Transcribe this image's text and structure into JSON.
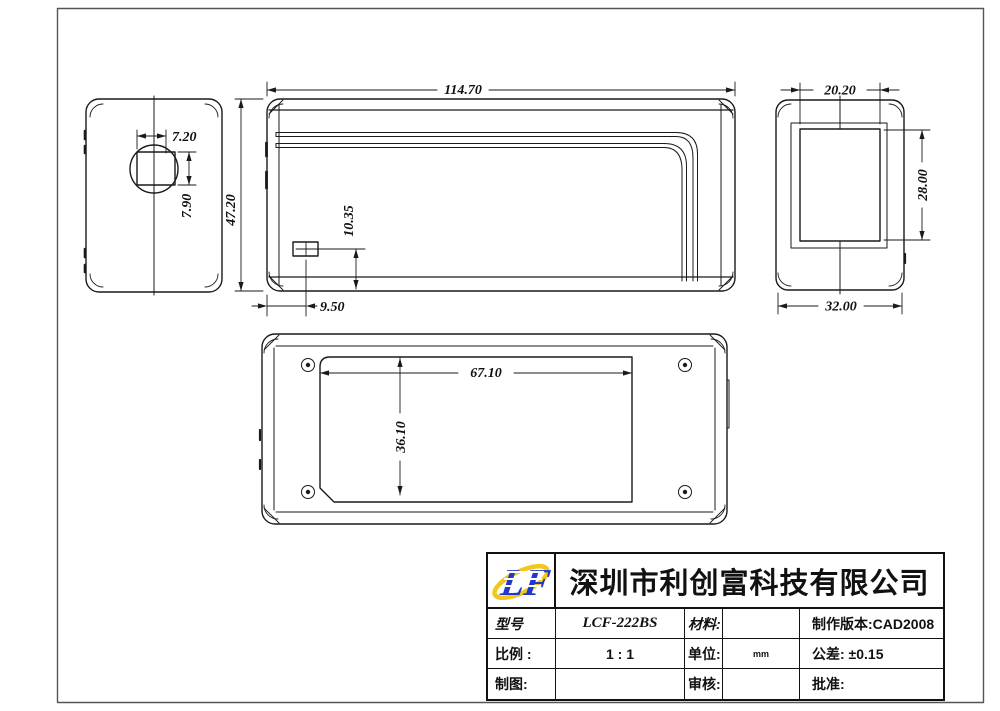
{
  "drawing": {
    "type": "CAD orthographic views of power adapter enclosure",
    "views": [
      "left-end-view",
      "front-view",
      "right-end-view",
      "bottom-view"
    ]
  },
  "dims": {
    "front_width": "114.70",
    "front_height": "47.20",
    "pin_hole_width": "7.20",
    "pin_hole_height": "7.90",
    "led_offset_x": "9.50",
    "led_offset_y": "10.35",
    "recess_width": "20.20",
    "recess_height": "28.00",
    "side_width": "32.00",
    "label_width": "67.10",
    "label_height": "36.10"
  },
  "title_block": {
    "company": "深圳市利创富科技有限公司",
    "logo_text": "LF",
    "model_label": "型号",
    "model_value": "LCF-222BS",
    "material_label": "材料:",
    "version_text": "制作版本:CAD2008",
    "scale_label": "比例 :",
    "scale_value": "1 : 1",
    "unit_label": "单位:",
    "unit_value": "mm",
    "tolerance_text": "公差: ±0.15",
    "drawn_label": "制图:",
    "checked_label": "审核:",
    "approved_label": "批准:"
  },
  "colors": {
    "line": "#1a1a1a",
    "frame": "#555555",
    "logo_blue": "#2337c9",
    "logo_yellow": "#f2c71d"
  }
}
